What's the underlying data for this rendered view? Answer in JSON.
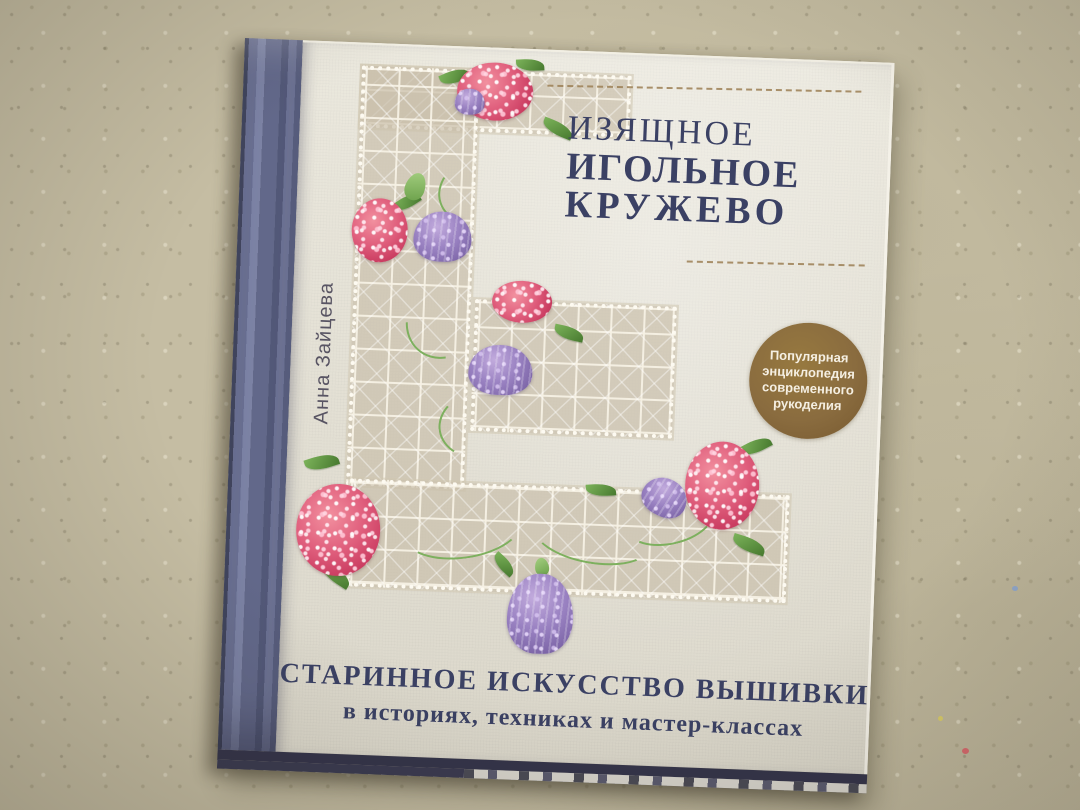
{
  "scene": {
    "surface_color": "#c5bda3"
  },
  "book": {
    "author": "Анна Зайцева",
    "title": {
      "line1": "ИЗЯЩНОЕ",
      "line2": "ИГОЛЬНОЕ",
      "line3": "КРУЖЕВО",
      "color": "#3b4164"
    },
    "badge": {
      "line1": "Популярная",
      "line2": "энциклопедия",
      "line3": "современного",
      "line4": "рукоделия",
      "background_color": "#8a6c3f",
      "text_color": "#f5efe2"
    },
    "subtitle": {
      "line1": "СТАРИННОЕ ИСКУССТВО ВЫШИВКИ",
      "line2": "в историях, техниках и мастер-классах",
      "color": "#3b4164"
    },
    "colors": {
      "cover": "#e9e6da",
      "spine": "#666c8c",
      "lace": "#cabfaa",
      "flower_pink": "#d94f72",
      "flower_purple": "#8f79b8",
      "leaf_green": "#5f9c49",
      "gold_rule": "#9c7f54"
    }
  }
}
